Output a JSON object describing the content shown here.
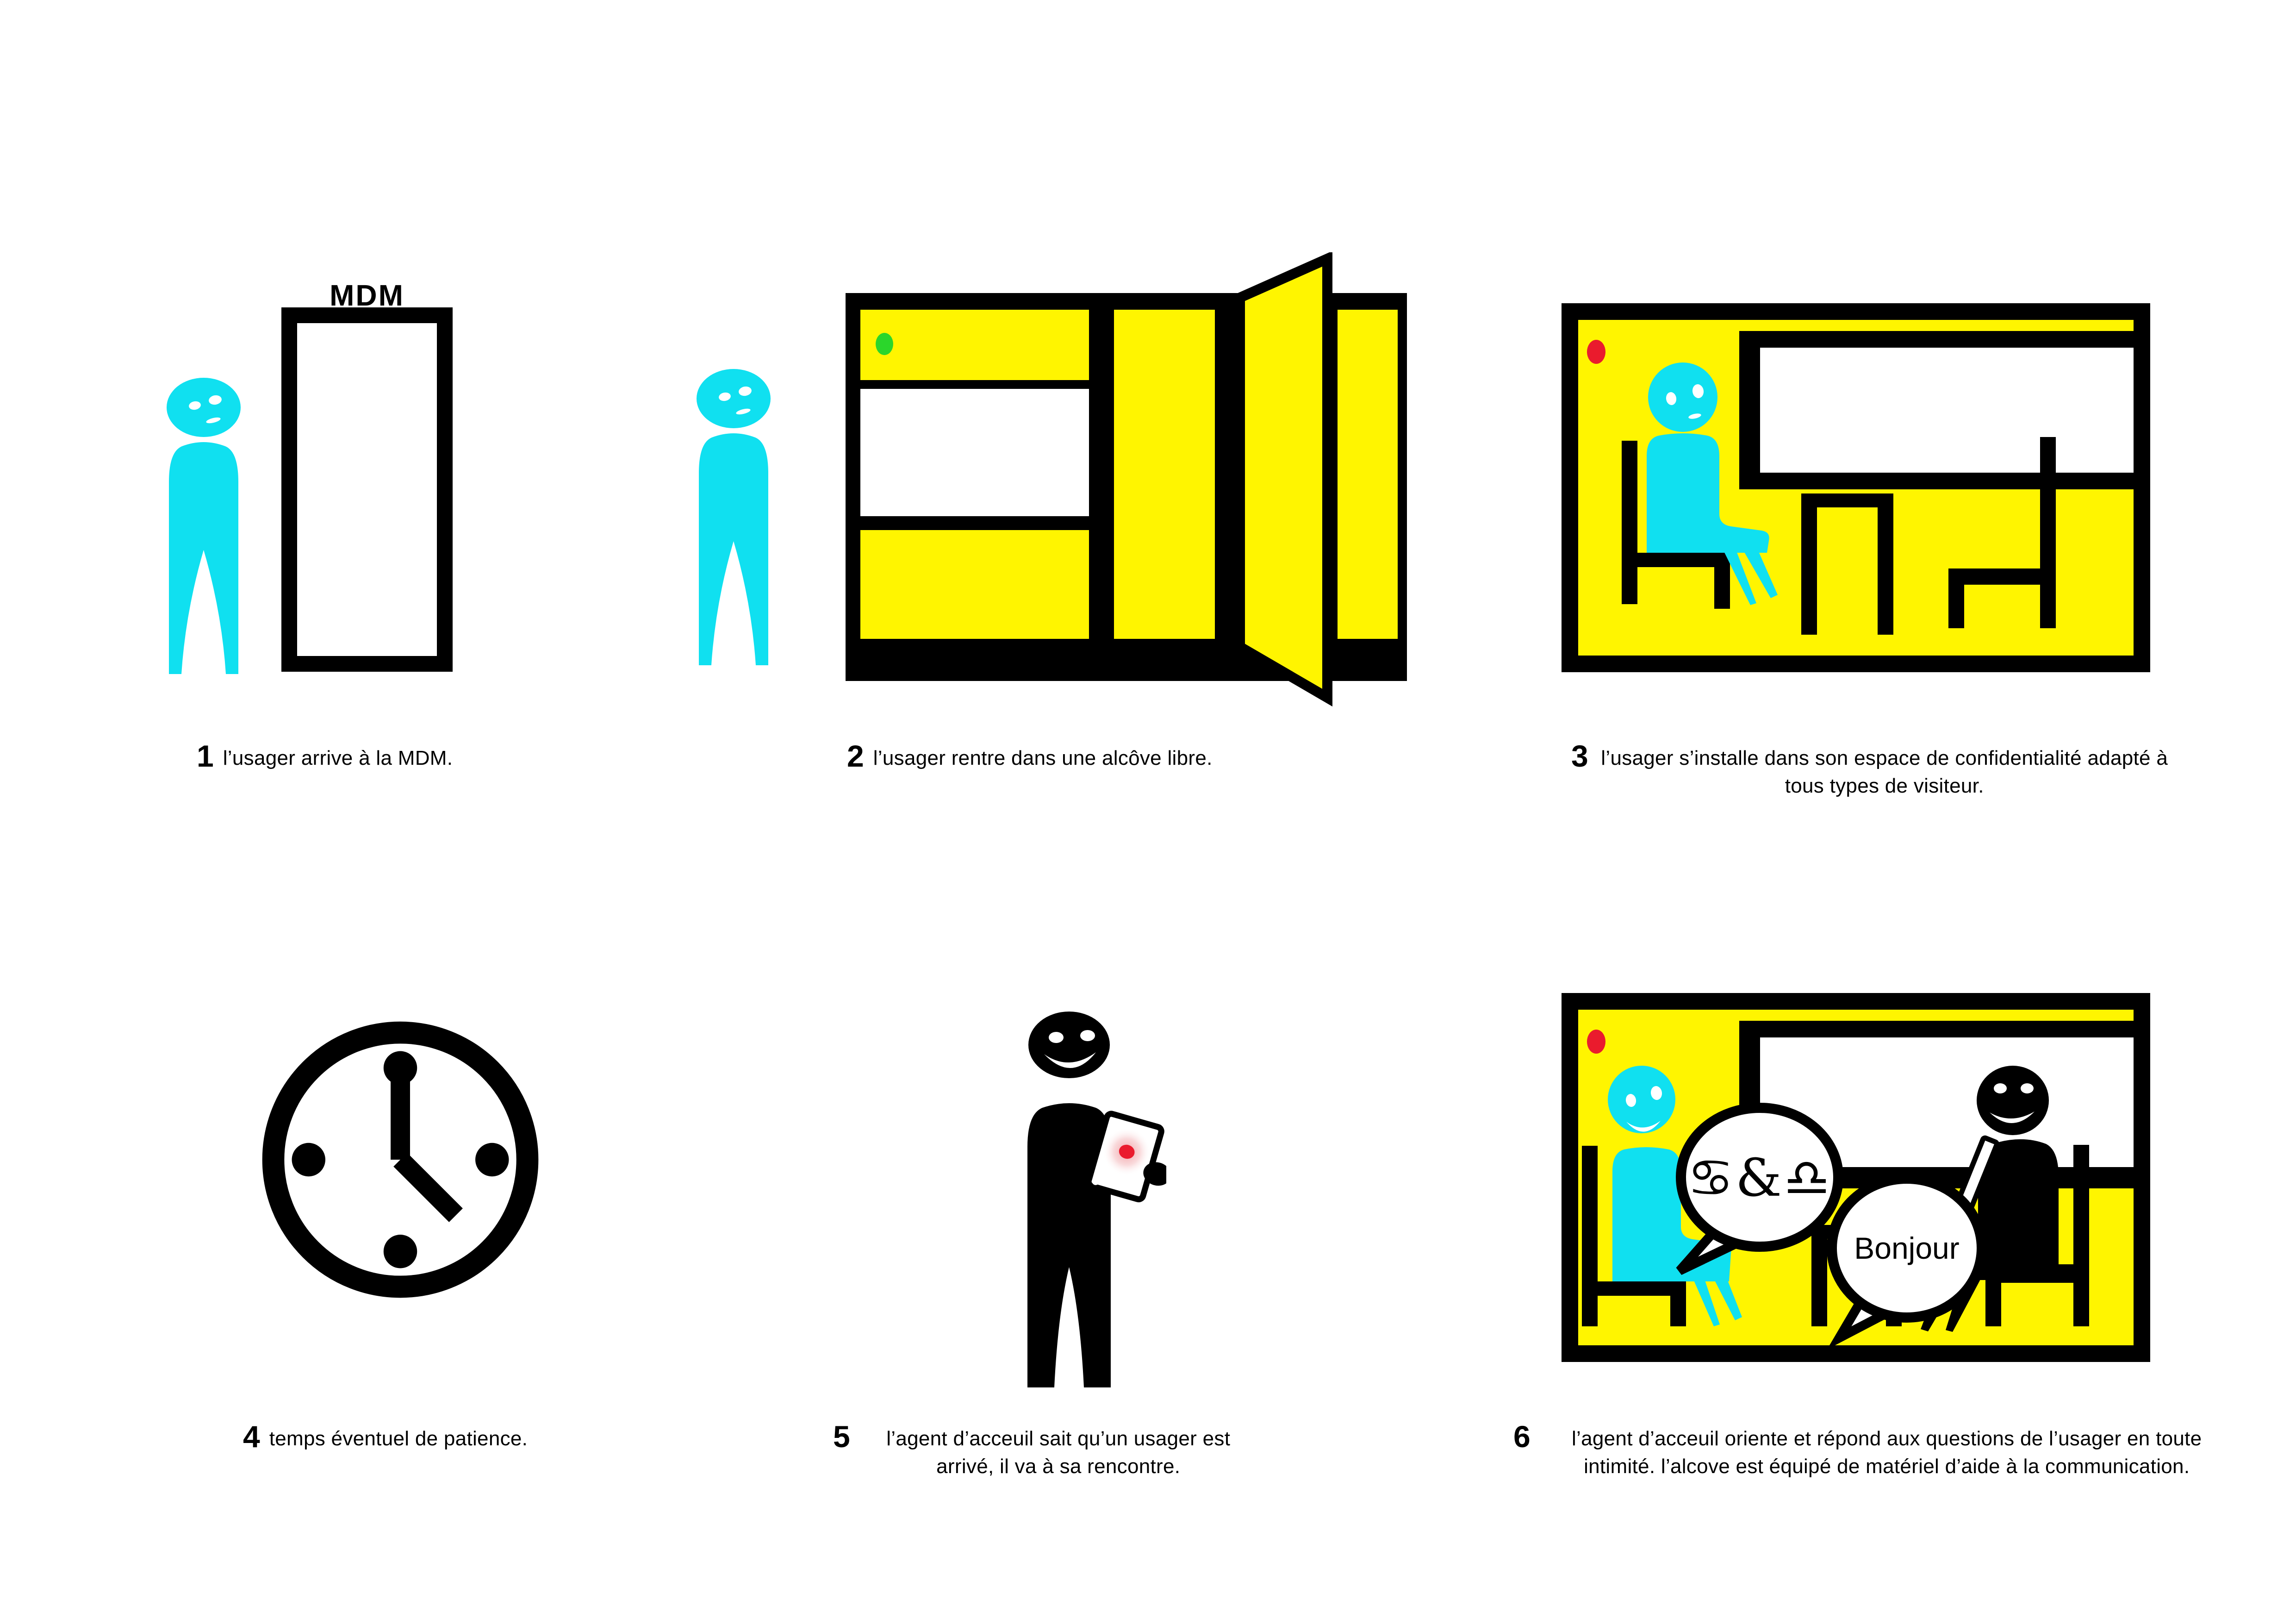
{
  "palette": {
    "cyan": "#10E0F0",
    "yellow": "#FFF500",
    "green": "#2BD62B",
    "red": "#EA1B2D",
    "black": "#000000",
    "white": "#FFFFFF",
    "glow_pink": "#F2A2A6"
  },
  "figures": {
    "mdm_sign": "MDM",
    "bubble_signs": "♋&♎",
    "bubble_greeting": "Bonjour"
  },
  "steps": [
    {
      "number": "1",
      "caption": "l’usager arrive à la MDM."
    },
    {
      "number": "2",
      "caption": "l’usager rentre dans une alcôve libre."
    },
    {
      "number": "3",
      "caption": "l’usager s’installe dans son espace de confidentialité adapté à tous types de visiteur."
    },
    {
      "number": "4",
      "caption": "temps éventuel de patience."
    },
    {
      "number": "5",
      "caption": "l’agent d’acceuil sait qu’un usager est arrivé, il va à sa rencontre."
    },
    {
      "number": "6",
      "caption": "l’agent d’acceuil oriente et répond aux questions de l’usager en toute intimité. l’alcove est équipé de matériel d’aide à la communication."
    }
  ]
}
